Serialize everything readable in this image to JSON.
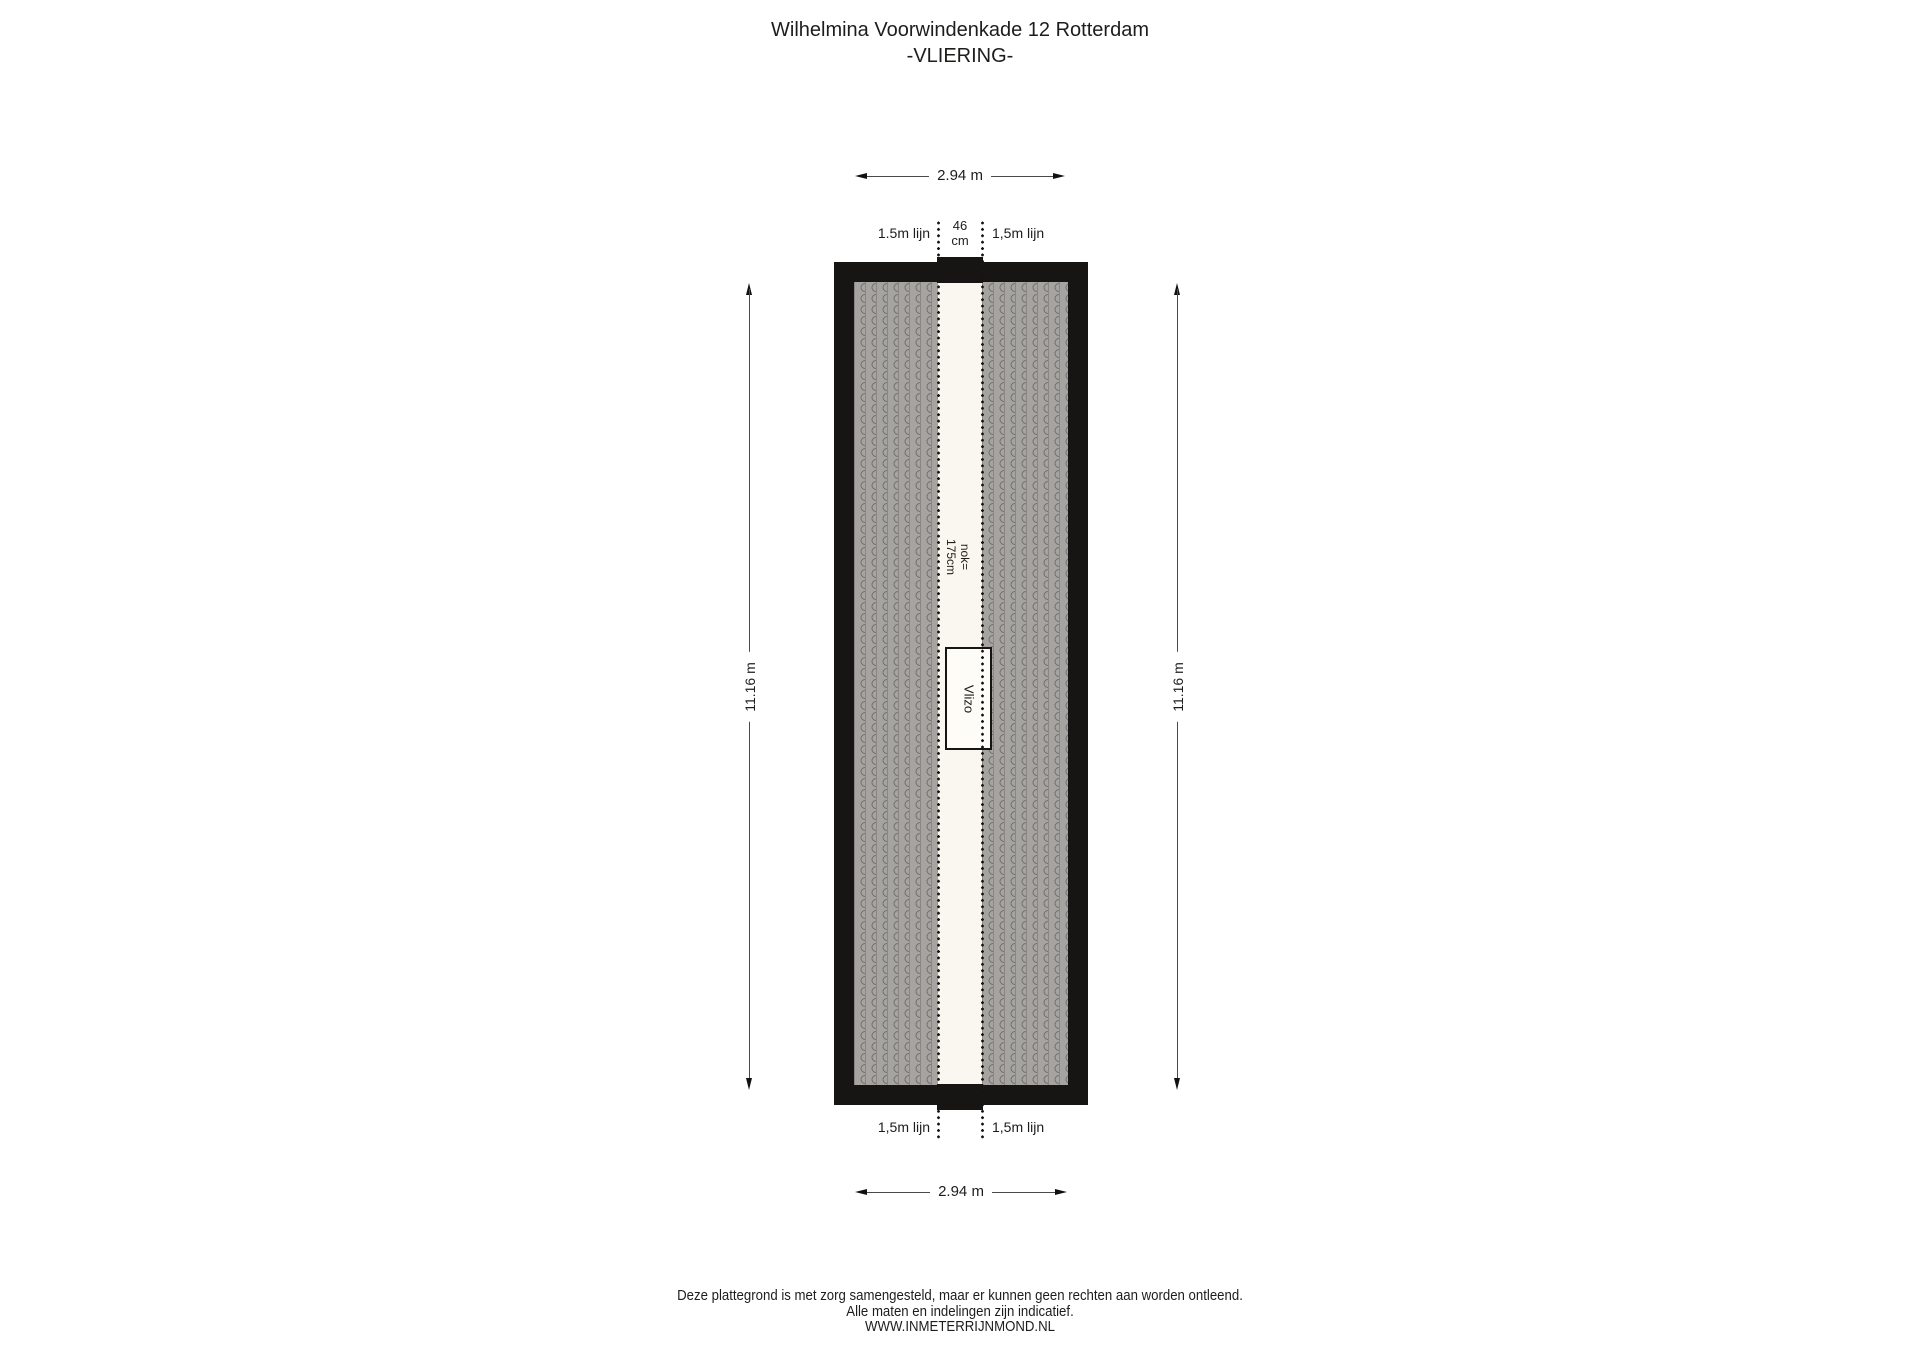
{
  "title": {
    "address": "Wilhelmina Voorwindenkade 12 Rotterdam",
    "floor": "-VLIERING-"
  },
  "dimensions": {
    "width_top": "2.94 m",
    "width_bottom": "2.94 m",
    "height_left": "11.16 m",
    "height_right": "11.16 m",
    "ridge_gap_value": "46",
    "ridge_gap_unit": "cm",
    "ridge_height_line1": "nok=",
    "ridge_height_line2": "175cm"
  },
  "headroom_lines": {
    "top_left": "1.5m lijn",
    "top_right": "1,5m lijn",
    "bottom_left": "1,5m lijn",
    "bottom_right": "1,5m lijn"
  },
  "objects": {
    "loft_ladder": "Vlizo"
  },
  "footer": {
    "line1": "Deze plattegrond is met zorg samengesteld, maar er kunnen geen rechten aan worden ontleend.",
    "line2": "Alle maten en indelingen zijn indicatief.",
    "line3": "WWW.INMETERRIJNMOND.NL"
  },
  "colors": {
    "wall": "#161514",
    "hatch": "#a6a4a0",
    "floor": "#f9f7ef",
    "ink": "#1d1d1b"
  }
}
